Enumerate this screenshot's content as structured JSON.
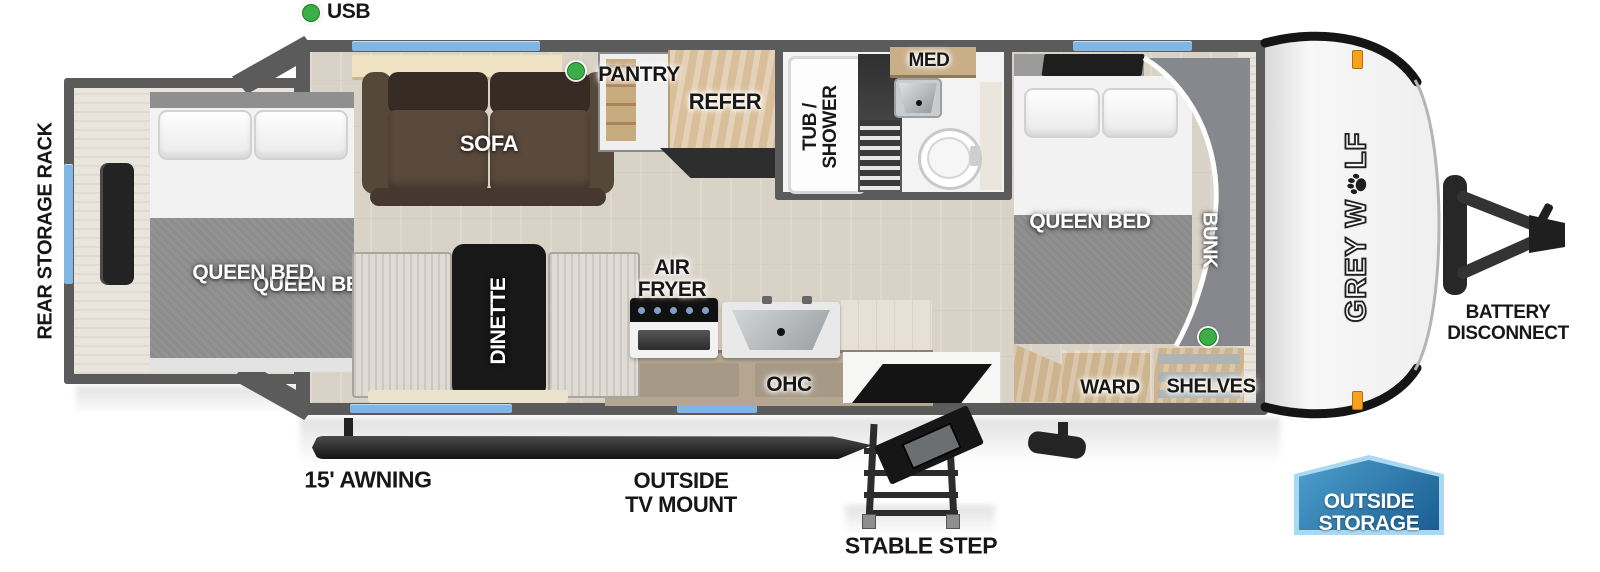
{
  "legend": {
    "usb": "USB"
  },
  "labels": {
    "rear_storage_rack": "REAR STORAGE RACK",
    "queen_bed_rear": "QUEEN BED",
    "sofa": "SOFA",
    "pantry": "PANTRY",
    "refer": "REFER",
    "tub_shower_line1": "TUB /",
    "tub_shower_line2": "SHOWER",
    "med": "MED",
    "air_fryer_line1": "AIR",
    "air_fryer_line2": "FRYER",
    "dinette": "DINETTE",
    "ohc": "OHC",
    "queen_bed_front": "QUEEN BED",
    "bunk": "BUNK",
    "ward": "WARD",
    "shelves": "SHELVES",
    "awning": "15' AWNING",
    "outside_tv_mount_line1": "OUTSIDE",
    "outside_tv_mount_line2": "TV MOUNT",
    "stable_step": "STABLE STEP",
    "battery_line1": "BATTERY",
    "battery_line2": "DISCONNECT",
    "outside_storage_line1": "OUTSIDE",
    "outside_storage_line2": "STORAGE"
  },
  "brand": {
    "name": "GREY WOLF",
    "part1": "GREY W",
    "part2": "LF"
  },
  "colors": {
    "wall_gray": "#5b5b5b",
    "window_blue": "#7fb6e4",
    "usb_green": "#3cae47",
    "marker_orange": "#f7a21d",
    "badge_blue_dark": "#1a5d92",
    "badge_blue_light": "#4da0cd",
    "badge_border": "#a9d9f2",
    "floor_wood": "#d9d2c7"
  }
}
